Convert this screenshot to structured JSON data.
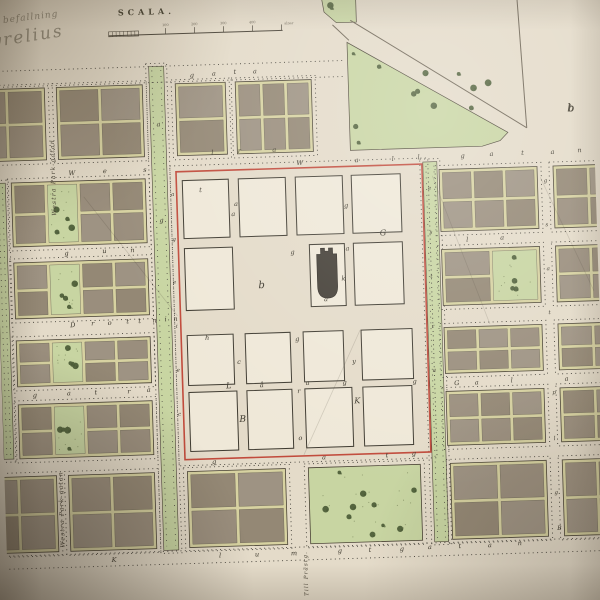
{
  "annotations": {
    "handwriting_line1": "te befallning",
    "handwriting_line2": "gyrelius",
    "corner_letter_b": "b"
  },
  "scale_bar": {
    "title": "SCALA.",
    "tick_labels": [
      "100",
      "200",
      "300",
      "400"
    ],
    "unit": "alnar"
  },
  "colors": {
    "paper": "#e4dbc9",
    "white": "#efe8d8",
    "lane": "#d7d2a1",
    "brown1": "#9a8e7d",
    "brown2": "#948875",
    "brown3": "#9e9383",
    "park": "#c8d5a2",
    "tree": "#55653f",
    "tree2": "#47573390",
    "speckle": "#7e8b5f",
    "dots": "#45423a",
    "outline": "#4a4335",
    "lotline": "#6b6454",
    "blockline": "#3f3b31",
    "red": "#c14b3c",
    "ink": "#3c382d",
    "church": "#443f37",
    "line": "#6e6555"
  },
  "map": {
    "blocks": [
      {
        "x": -24,
        "y": 80,
        "w": 76,
        "h": 72,
        "t": "lots",
        "c": 2,
        "r": 2
      },
      {
        "x": 64,
        "y": 80,
        "w": 86,
        "h": 72,
        "t": "lots",
        "c": 2,
        "r": 2
      },
      {
        "x": 183,
        "y": 80,
        "w": 50,
        "h": 72,
        "t": "lots",
        "c": 1,
        "r": 2
      },
      {
        "x": 243,
        "y": 80,
        "w": 76,
        "h": 72,
        "t": "lots",
        "c": 3,
        "r": 2
      },
      {
        "x": 16,
        "y": 174,
        "w": 134,
        "h": 64,
        "t": "lots",
        "c": 4,
        "r": 2,
        "g": 1
      },
      {
        "x": 16,
        "y": 254,
        "w": 134,
        "h": 56,
        "t": "lots",
        "c": 4,
        "r": 2,
        "g": 1
      },
      {
        "x": 16,
        "y": 332,
        "w": 134,
        "h": 46,
        "t": "lots",
        "c": 4,
        "r": 2,
        "g": 1
      },
      {
        "x": 16,
        "y": 396,
        "w": 134,
        "h": 54,
        "t": "lots",
        "c": 4,
        "r": 2,
        "g": 1
      },
      {
        "x": -24,
        "y": 468,
        "w": 76,
        "h": 76,
        "t": "lots",
        "c": 2,
        "r": 2
      },
      {
        "x": 64,
        "y": 468,
        "w": 86,
        "h": 76,
        "t": "lots",
        "c": 2,
        "r": 2
      },
      {
        "x": 183,
        "y": 468,
        "w": 98,
        "h": 76,
        "t": "lots",
        "c": 2,
        "r": 2
      },
      {
        "x": 304,
        "y": 468,
        "w": 112,
        "h": 76,
        "t": "park",
        "n": 10
      },
      {
        "x": 444,
        "y": 174,
        "w": 98,
        "h": 62,
        "t": "lots",
        "c": 3,
        "r": 2
      },
      {
        "x": 558,
        "y": 174,
        "w": 70,
        "h": 62,
        "t": "lots",
        "c": 2,
        "r": 2
      },
      {
        "x": 444,
        "y": 254,
        "w": 98,
        "h": 56,
        "t": "lots",
        "c": 2,
        "r": 2,
        "g": 1
      },
      {
        "x": 558,
        "y": 254,
        "w": 70,
        "h": 56,
        "t": "lots",
        "c": 2,
        "r": 2
      },
      {
        "x": 444,
        "y": 332,
        "w": 98,
        "h": 46,
        "t": "lots",
        "c": 3,
        "r": 2
      },
      {
        "x": 558,
        "y": 332,
        "w": 70,
        "h": 46,
        "t": "lots",
        "c": 2,
        "r": 2
      },
      {
        "x": 444,
        "y": 396,
        "w": 98,
        "h": 54,
        "t": "lots",
        "c": 3,
        "r": 2
      },
      {
        "x": 558,
        "y": 396,
        "w": 70,
        "h": 54,
        "t": "lots",
        "c": 2,
        "r": 2
      },
      {
        "x": 446,
        "y": 468,
        "w": 96,
        "h": 76,
        "t": "lots",
        "c": 2,
        "r": 2
      },
      {
        "x": 558,
        "y": 468,
        "w": 70,
        "h": 76,
        "t": "lots",
        "c": 2,
        "r": 2
      }
    ],
    "white_blocks": [
      {
        "x": 187,
        "y": 177,
        "w": 46,
        "h": 58
      },
      {
        "x": 243,
        "y": 177,
        "w": 47,
        "h": 58
      },
      {
        "x": 300,
        "y": 177,
        "w": 47,
        "h": 58
      },
      {
        "x": 356,
        "y": 177,
        "w": 49,
        "h": 58
      },
      {
        "x": 187,
        "y": 245,
        "w": 48,
        "h": 62
      },
      {
        "x": 312,
        "y": 245,
        "w": 35,
        "h": 62
      },
      {
        "x": 356,
        "y": 245,
        "w": 49,
        "h": 62
      },
      {
        "x": 187,
        "y": 332,
        "w": 46,
        "h": 50
      },
      {
        "x": 245,
        "y": 332,
        "w": 45,
        "h": 50
      },
      {
        "x": 303,
        "y": 332,
        "w": 40,
        "h": 50
      },
      {
        "x": 361,
        "y": 332,
        "w": 51,
        "h": 50
      },
      {
        "x": 187,
        "y": 389,
        "w": 48,
        "h": 59
      },
      {
        "x": 245,
        "y": 389,
        "w": 45,
        "h": 59
      },
      {
        "x": 303,
        "y": 389,
        "w": 47,
        "h": 59
      },
      {
        "x": 361,
        "y": 389,
        "w": 49,
        "h": 59
      }
    ],
    "esplanades": [
      {
        "x": 0,
        "y": 174,
        "w": 10,
        "h": 276
      },
      {
        "x": 157,
        "y": 62,
        "w": 15,
        "h": 484
      },
      {
        "x": 428,
        "y": 166,
        "w": 14,
        "h": 380
      }
    ],
    "red_district": {
      "x": 181,
      "y": 168,
      "w": 246,
      "h": 288
    },
    "church": {
      "x": 319,
      "y": 249,
      "w": 20,
      "h": 50
    },
    "triangle_park": {
      "pts": "356,44 356,152 488,152 506,147 514,139",
      "n": 14
    },
    "sliver_park": {
      "pts": "332,0 366,0 366,24 346,24 334,13",
      "n": 2
    },
    "diag_lines": [
      [
        360,
        22,
        533,
        135
      ],
      [
        527,
        0,
        533,
        135
      ],
      [
        342,
        26,
        358,
        42
      ]
    ],
    "scratches": [
      [
        88,
        190,
        178,
        312
      ],
      [
        437,
        180,
        490,
        330
      ],
      [
        545,
        185,
        595,
        300
      ],
      [
        300,
        455,
        360,
        332
      ]
    ],
    "street_dot_lines": [
      [
        -20,
        62,
        352,
        62
      ],
      [
        -20,
        78,
        352,
        78
      ],
      [
        -20,
        547,
        620,
        547
      ],
      [
        -20,
        560,
        620,
        560
      ]
    ],
    "scale_bar_geom": {
      "x1": 118,
      "x2": 292,
      "y": 30,
      "hatch_w": 30,
      "ticks": [
        175,
        204,
        233,
        262,
        291
      ]
    },
    "letters": [
      [
        "g",
        200,
        74
      ],
      [
        "a",
        222,
        73
      ],
      [
        "t",
        243,
        72
      ],
      [
        "a",
        263,
        72
      ],
      [
        "W",
        305,
        165
      ],
      [
        "a",
        362,
        164
      ],
      [
        "l",
        398,
        164
      ],
      [
        "l",
        424,
        163
      ],
      [
        "g",
        468,
        163
      ],
      [
        "a",
        497,
        162
      ],
      [
        "t",
        528,
        162
      ],
      [
        "a",
        558,
        162
      ],
      [
        "n",
        585,
        161
      ],
      [
        "W",
        77,
        168
      ],
      [
        "e",
        110,
        167
      ],
      [
        "s",
        150,
        167
      ],
      [
        "l",
        218,
        152
      ],
      [
        "r",
        245,
        151
      ],
      [
        "a",
        280,
        151
      ],
      [
        "g",
        69,
        248
      ],
      [
        "u",
        107,
        247
      ],
      [
        "n",
        135,
        247
      ],
      [
        "l",
        470,
        247
      ],
      [
        "a",
        505,
        246
      ],
      [
        "D",
        73,
        320
      ],
      [
        "r",
        93,
        319
      ],
      [
        "o",
        110,
        319
      ],
      [
        "t",
        128,
        318
      ],
      [
        "t",
        140,
        318
      ],
      [
        "n",
        155,
        318
      ],
      [
        "i",
        166,
        317
      ],
      [
        "n",
        176,
        317
      ],
      [
        "g",
        33,
        389
      ],
      [
        "a",
        67,
        388
      ],
      [
        "t",
        94,
        388
      ],
      [
        "r",
        127,
        388
      ],
      [
        "a",
        147,
        387
      ],
      [
        "G",
        455,
        390
      ],
      [
        "a",
        475,
        390
      ],
      [
        "l",
        510,
        389
      ],
      [
        "a",
        565,
        389
      ],
      [
        "g",
        210,
        461
      ],
      [
        "a",
        320,
        460
      ],
      [
        "t",
        383,
        460
      ],
      [
        "g",
        410,
        459
      ],
      [
        "K",
        107,
        556
      ],
      [
        "l",
        213,
        555
      ],
      [
        "u",
        250,
        555
      ],
      [
        "m",
        287,
        555
      ],
      [
        "g",
        333,
        554
      ],
      [
        "t",
        363,
        554
      ],
      [
        "g",
        395,
        554
      ],
      [
        "a",
        423,
        553
      ],
      [
        "t",
        453,
        553
      ],
      [
        "a",
        483,
        553
      ],
      [
        "n",
        513,
        552
      ],
      [
        "a",
        165,
        122
      ],
      [
        "g",
        165,
        218
      ],
      [
        "a",
        177,
        192,
        5.5
      ],
      [
        "g",
        177,
        237,
        5.5
      ],
      [
        "e",
        176,
        280,
        5.5
      ],
      [
        "i",
        177,
        324,
        5.5
      ],
      [
        "e",
        177,
        368,
        5.5
      ],
      [
        "c",
        177,
        412,
        5.5
      ],
      [
        "e",
        434,
        194,
        5.5
      ],
      [
        "s",
        434,
        238,
        5.5
      ],
      [
        "t",
        433,
        282,
        5.5
      ],
      [
        "r",
        433,
        332,
        5.5
      ],
      [
        "a",
        433,
        376,
        5.5
      ],
      [
        "t",
        205,
        189
      ],
      [
        "a",
        240,
        204
      ],
      [
        "a",
        237,
        214
      ],
      [
        "g",
        350,
        209
      ],
      [
        "G",
        386,
        238,
        8
      ],
      [
        "g",
        295,
        254
      ],
      [
        "a",
        350,
        252
      ],
      [
        "b",
        263,
        287,
        10
      ],
      [
        "k",
        345,
        282
      ],
      [
        "a",
        327,
        302
      ],
      [
        "h",
        207,
        337
      ],
      [
        "g",
        297,
        341
      ],
      [
        "y",
        353,
        365
      ],
      [
        "L",
        227,
        386,
        8
      ],
      [
        "å",
        260,
        386
      ],
      [
        "a",
        306,
        385
      ],
      [
        "g",
        343,
        386
      ],
      [
        "c",
        238,
        362
      ],
      [
        "B",
        240,
        420,
        9
      ],
      [
        "r",
        297,
        393
      ],
      [
        "o",
        297,
        440
      ],
      [
        "K",
        355,
        405,
        8
      ],
      [
        "g",
        413,
        387
      ],
      [
        "g",
        550,
        190,
        5.5
      ],
      [
        "s",
        550,
        234,
        5.5
      ],
      [
        "a",
        550,
        278,
        5.5
      ],
      [
        "t",
        550,
        322,
        5.5
      ],
      [
        "p",
        552,
        402,
        5.5
      ],
      [
        "l",
        551,
        448,
        5.5
      ],
      [
        "g",
        551,
        502,
        5.5
      ],
      [
        "B",
        553,
        538,
        6
      ],
      [
        "b",
        578,
        120,
        10
      ]
    ],
    "rotated_labels": [
      {
        "text": "Westra Park-gatan",
        "x": 60,
        "y": 208,
        "s": 6
      },
      {
        "text": "Westra Park-gatan",
        "x": 58,
        "y": 540,
        "s": 6
      },
      {
        "text": "Till Prästg.",
        "x": 300,
        "y": 596,
        "s": 5.5
      }
    ]
  }
}
